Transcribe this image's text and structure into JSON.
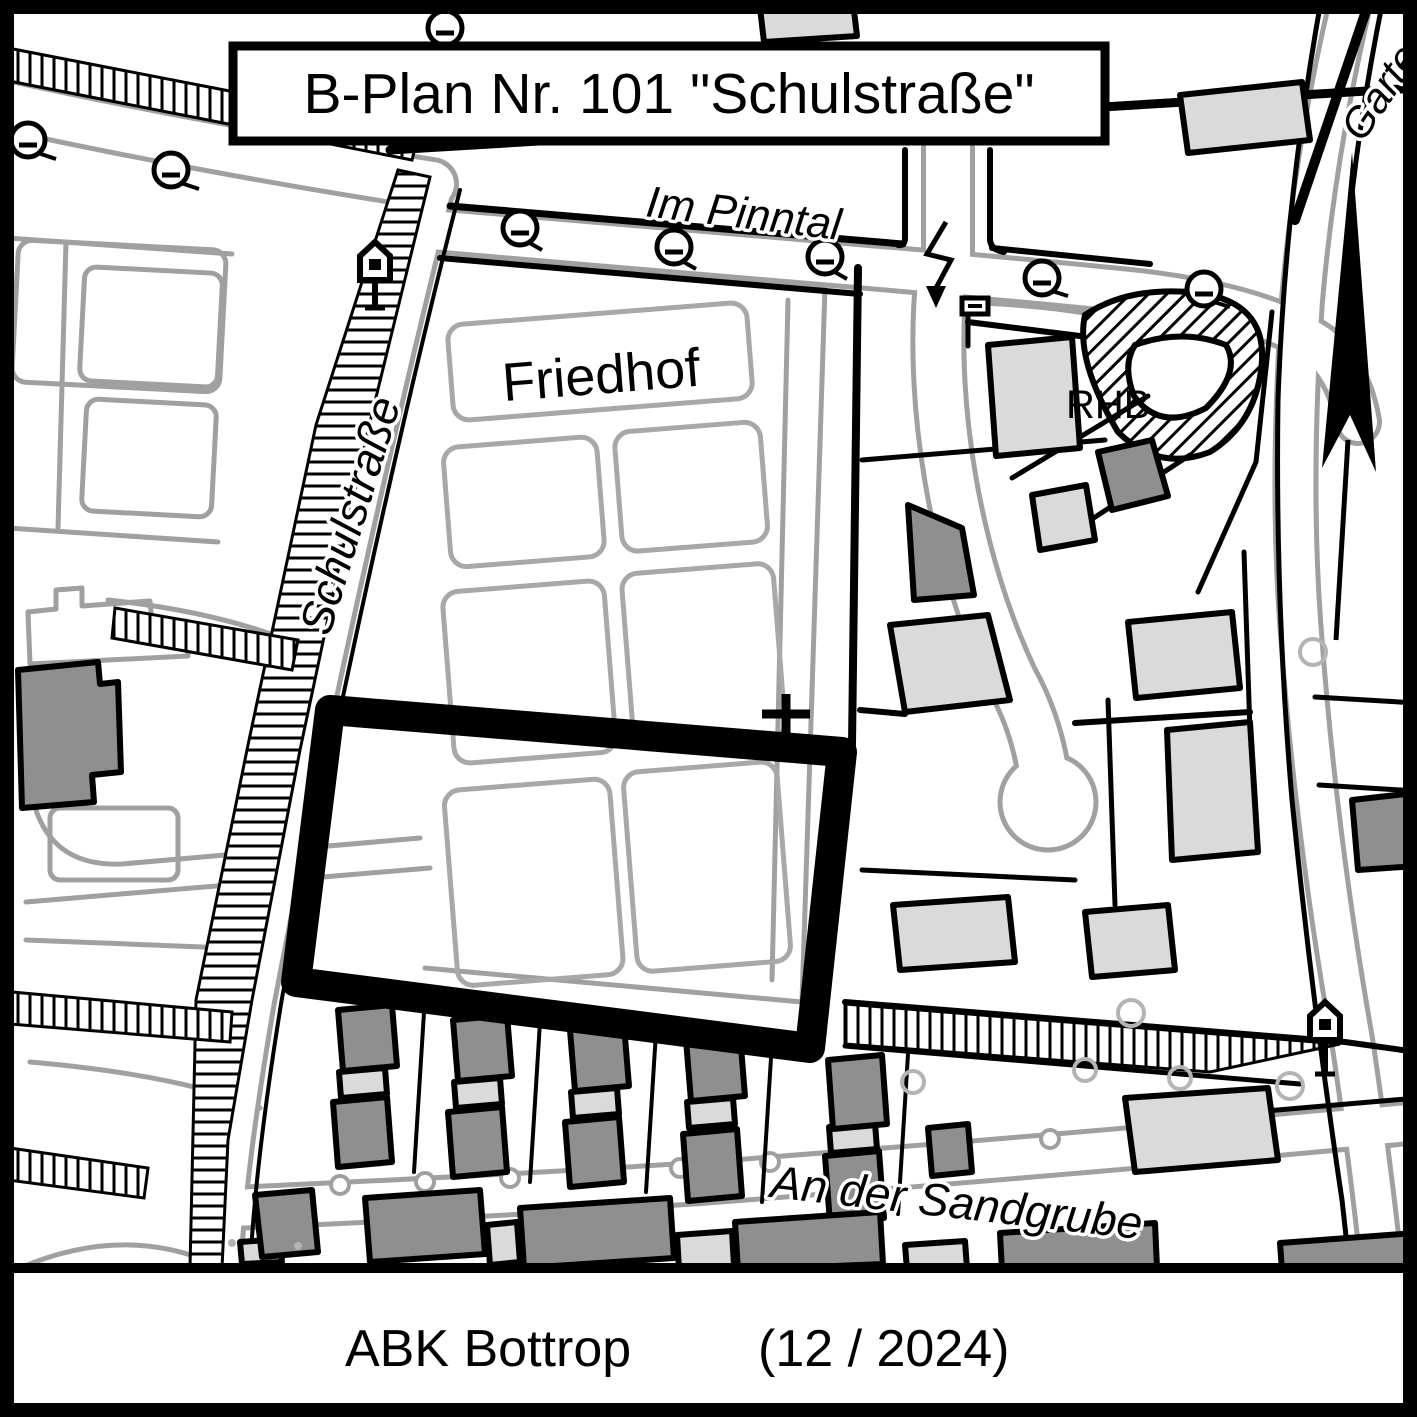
{
  "title_box": {
    "text": "B-Plan Nr. 101 \"Schulstraße\""
  },
  "street_labels": {
    "im_pinntal": "Im Pinntal",
    "schulstrasse": "Schulstraße",
    "an_der_sandgrube": "An der Sandgrube",
    "garten_truncated": "Garte"
  },
  "area_labels": {
    "cemetery": "Friedhof",
    "retention_basin": "RHB"
  },
  "footer": {
    "source": "ABK Bottrop",
    "edition": "(12 / 2024)"
  },
  "colors": {
    "ink": "#000000",
    "paper": "#ffffff",
    "parcel_line": "#a0a0a0",
    "building_dark": "#8f8f8f",
    "building_light": "#dadada",
    "tree_line": "#b4b4b4"
  }
}
